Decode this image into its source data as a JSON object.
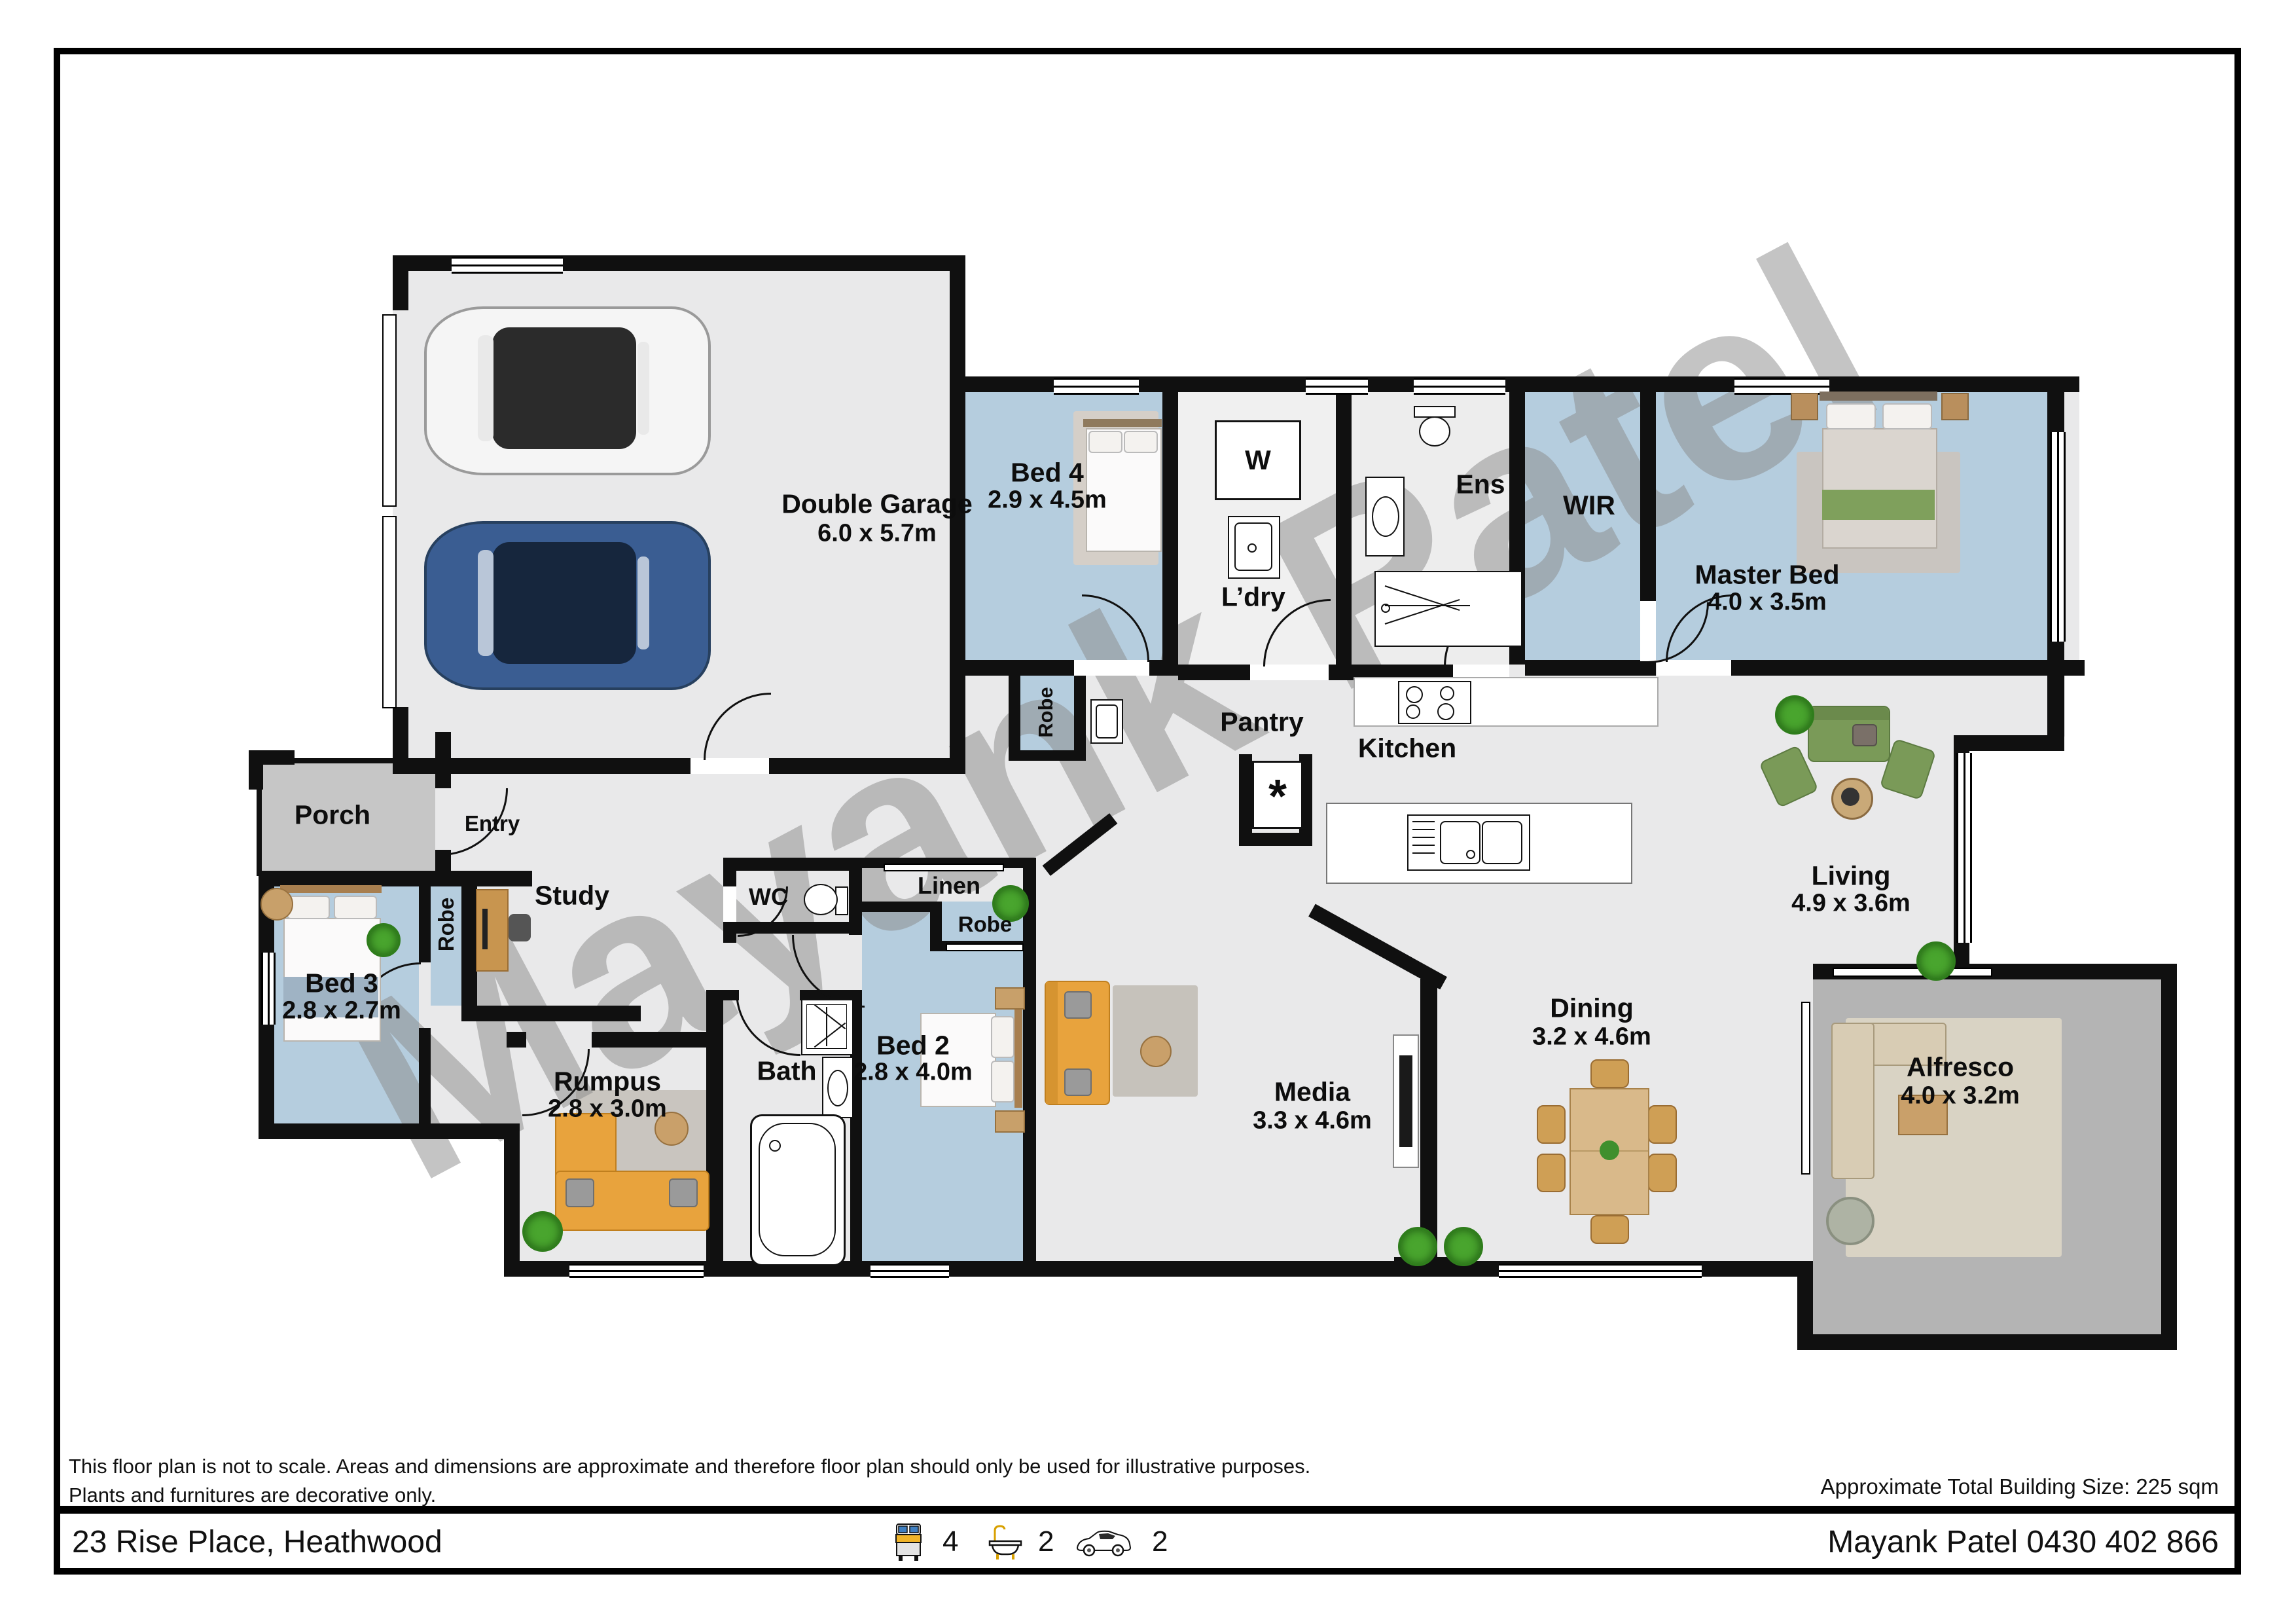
{
  "watermark": "Mayank Patel",
  "colors": {
    "wall": "#101010",
    "floor": "#e9e9ea",
    "blue": "#b5cdde",
    "porch": "#c6c6c6",
    "alf": "#b4b4b4",
    "alfrug": "#d9d3c4",
    "rug": "#c9c5bf",
    "yellow": "#e8a33d",
    "green": "#7a9a58",
    "carblue": "#3a5d92",
    "wood": "#c8954f",
    "wood2": "#d9b98a",
    "wm": "#8a8a8a"
  },
  "rooms": {
    "garage": {
      "name": "Double Garage",
      "dims": "6.0 x 5.7m"
    },
    "bed4": {
      "name": "Bed 4",
      "dims": "2.9 x 4.5m"
    },
    "ldry": {
      "name": "L’dry"
    },
    "ens": {
      "name": "Ens"
    },
    "wir": {
      "name": "WIR"
    },
    "master": {
      "name": "Master Bed",
      "dims": "4.0 x 3.5m"
    },
    "porch": {
      "name": "Porch"
    },
    "entry": {
      "name": "Entry"
    },
    "bed3": {
      "name": "Bed 3",
      "dims": "2.8 x 2.7m"
    },
    "robe_bed3": {
      "name": "Robe"
    },
    "study": {
      "name": "Study"
    },
    "rumpus": {
      "name": "Rumpus",
      "dims": "2.8 x 3.0m"
    },
    "robe_bed4": {
      "name": "Robe"
    },
    "pantry": {
      "name": "Pantry"
    },
    "kitchen": {
      "name": "Kitchen"
    },
    "wc": {
      "name": "WC"
    },
    "linen": {
      "name": "Linen"
    },
    "robe_bed2": {
      "name": "Robe"
    },
    "bed2": {
      "name": "Bed 2",
      "dims": "2.8 x 4.0m"
    },
    "bath": {
      "name": "Bath"
    },
    "media": {
      "name": "Media",
      "dims": "3.3 x 4.6m"
    },
    "dining": {
      "name": "Dining",
      "dims": "3.2 x 4.6m"
    },
    "living": {
      "name": "Living",
      "dims": "4.9 x 3.6m"
    },
    "alfresco": {
      "name": "Alfresco",
      "dims": "4.0 x 3.2m"
    }
  },
  "appliances": {
    "washer": "W",
    "pantry_star": "*"
  },
  "footer": {
    "disclaimer_line1": "This floor plan is not to scale. Areas and dimensions are approximate and therefore floor plan should only be used for illustrative purposes.",
    "disclaimer_line2": "Plants and furnitures are decorative only.",
    "building_size": "Approximate Total Building Size: 225 sqm",
    "address": "23 Rise Place, Heathwood",
    "agent": "Mayank Patel 0430 402 866",
    "stats": {
      "beds": "4",
      "baths": "2",
      "cars": "2"
    }
  }
}
